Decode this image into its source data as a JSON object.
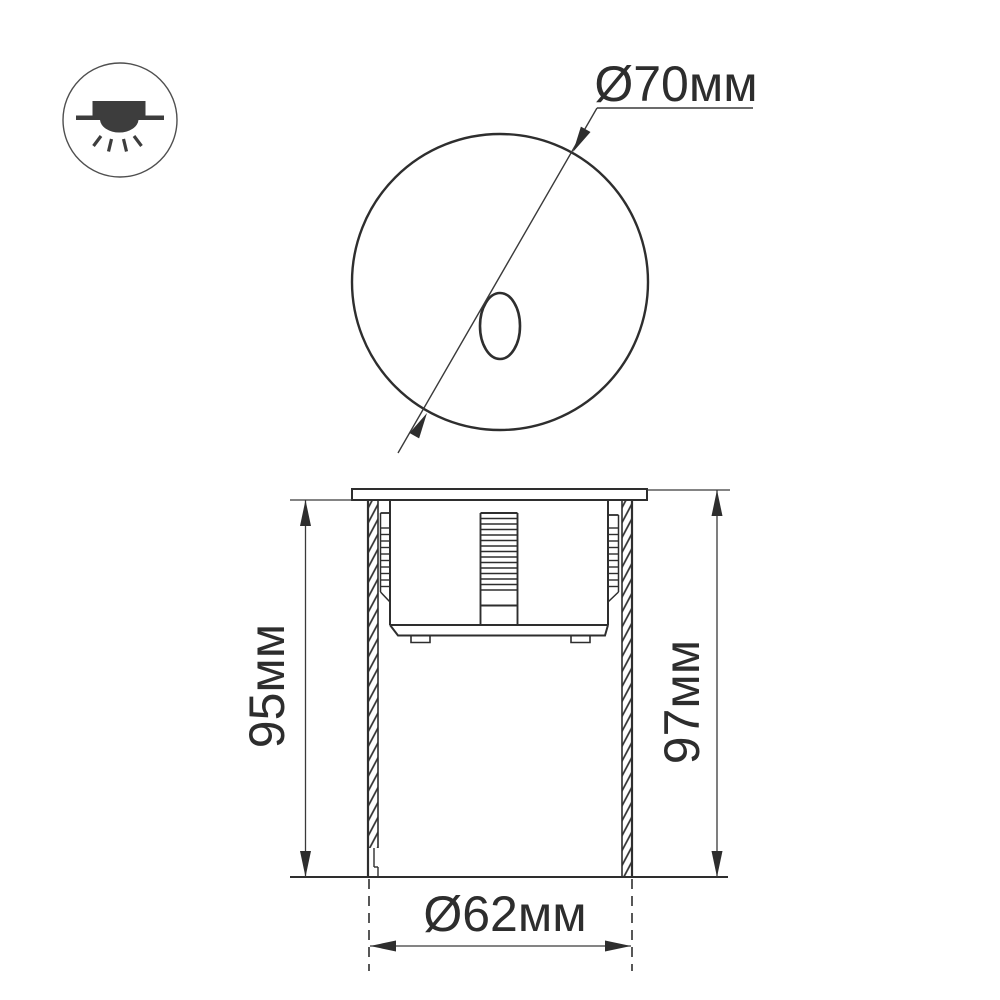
{
  "page": {
    "background": "#ffffff",
    "line_color": "#2e2e2e",
    "dim_line_color": "#3a3a3a",
    "icon_fill": "#3d3d3d"
  },
  "icon": {
    "name": "recessed-downlight"
  },
  "labels": {
    "top_diameter": "Ø70мм",
    "recess_depth": "95мм",
    "total_height": "97мм",
    "cutout_diameter": "Ø62мм"
  }
}
